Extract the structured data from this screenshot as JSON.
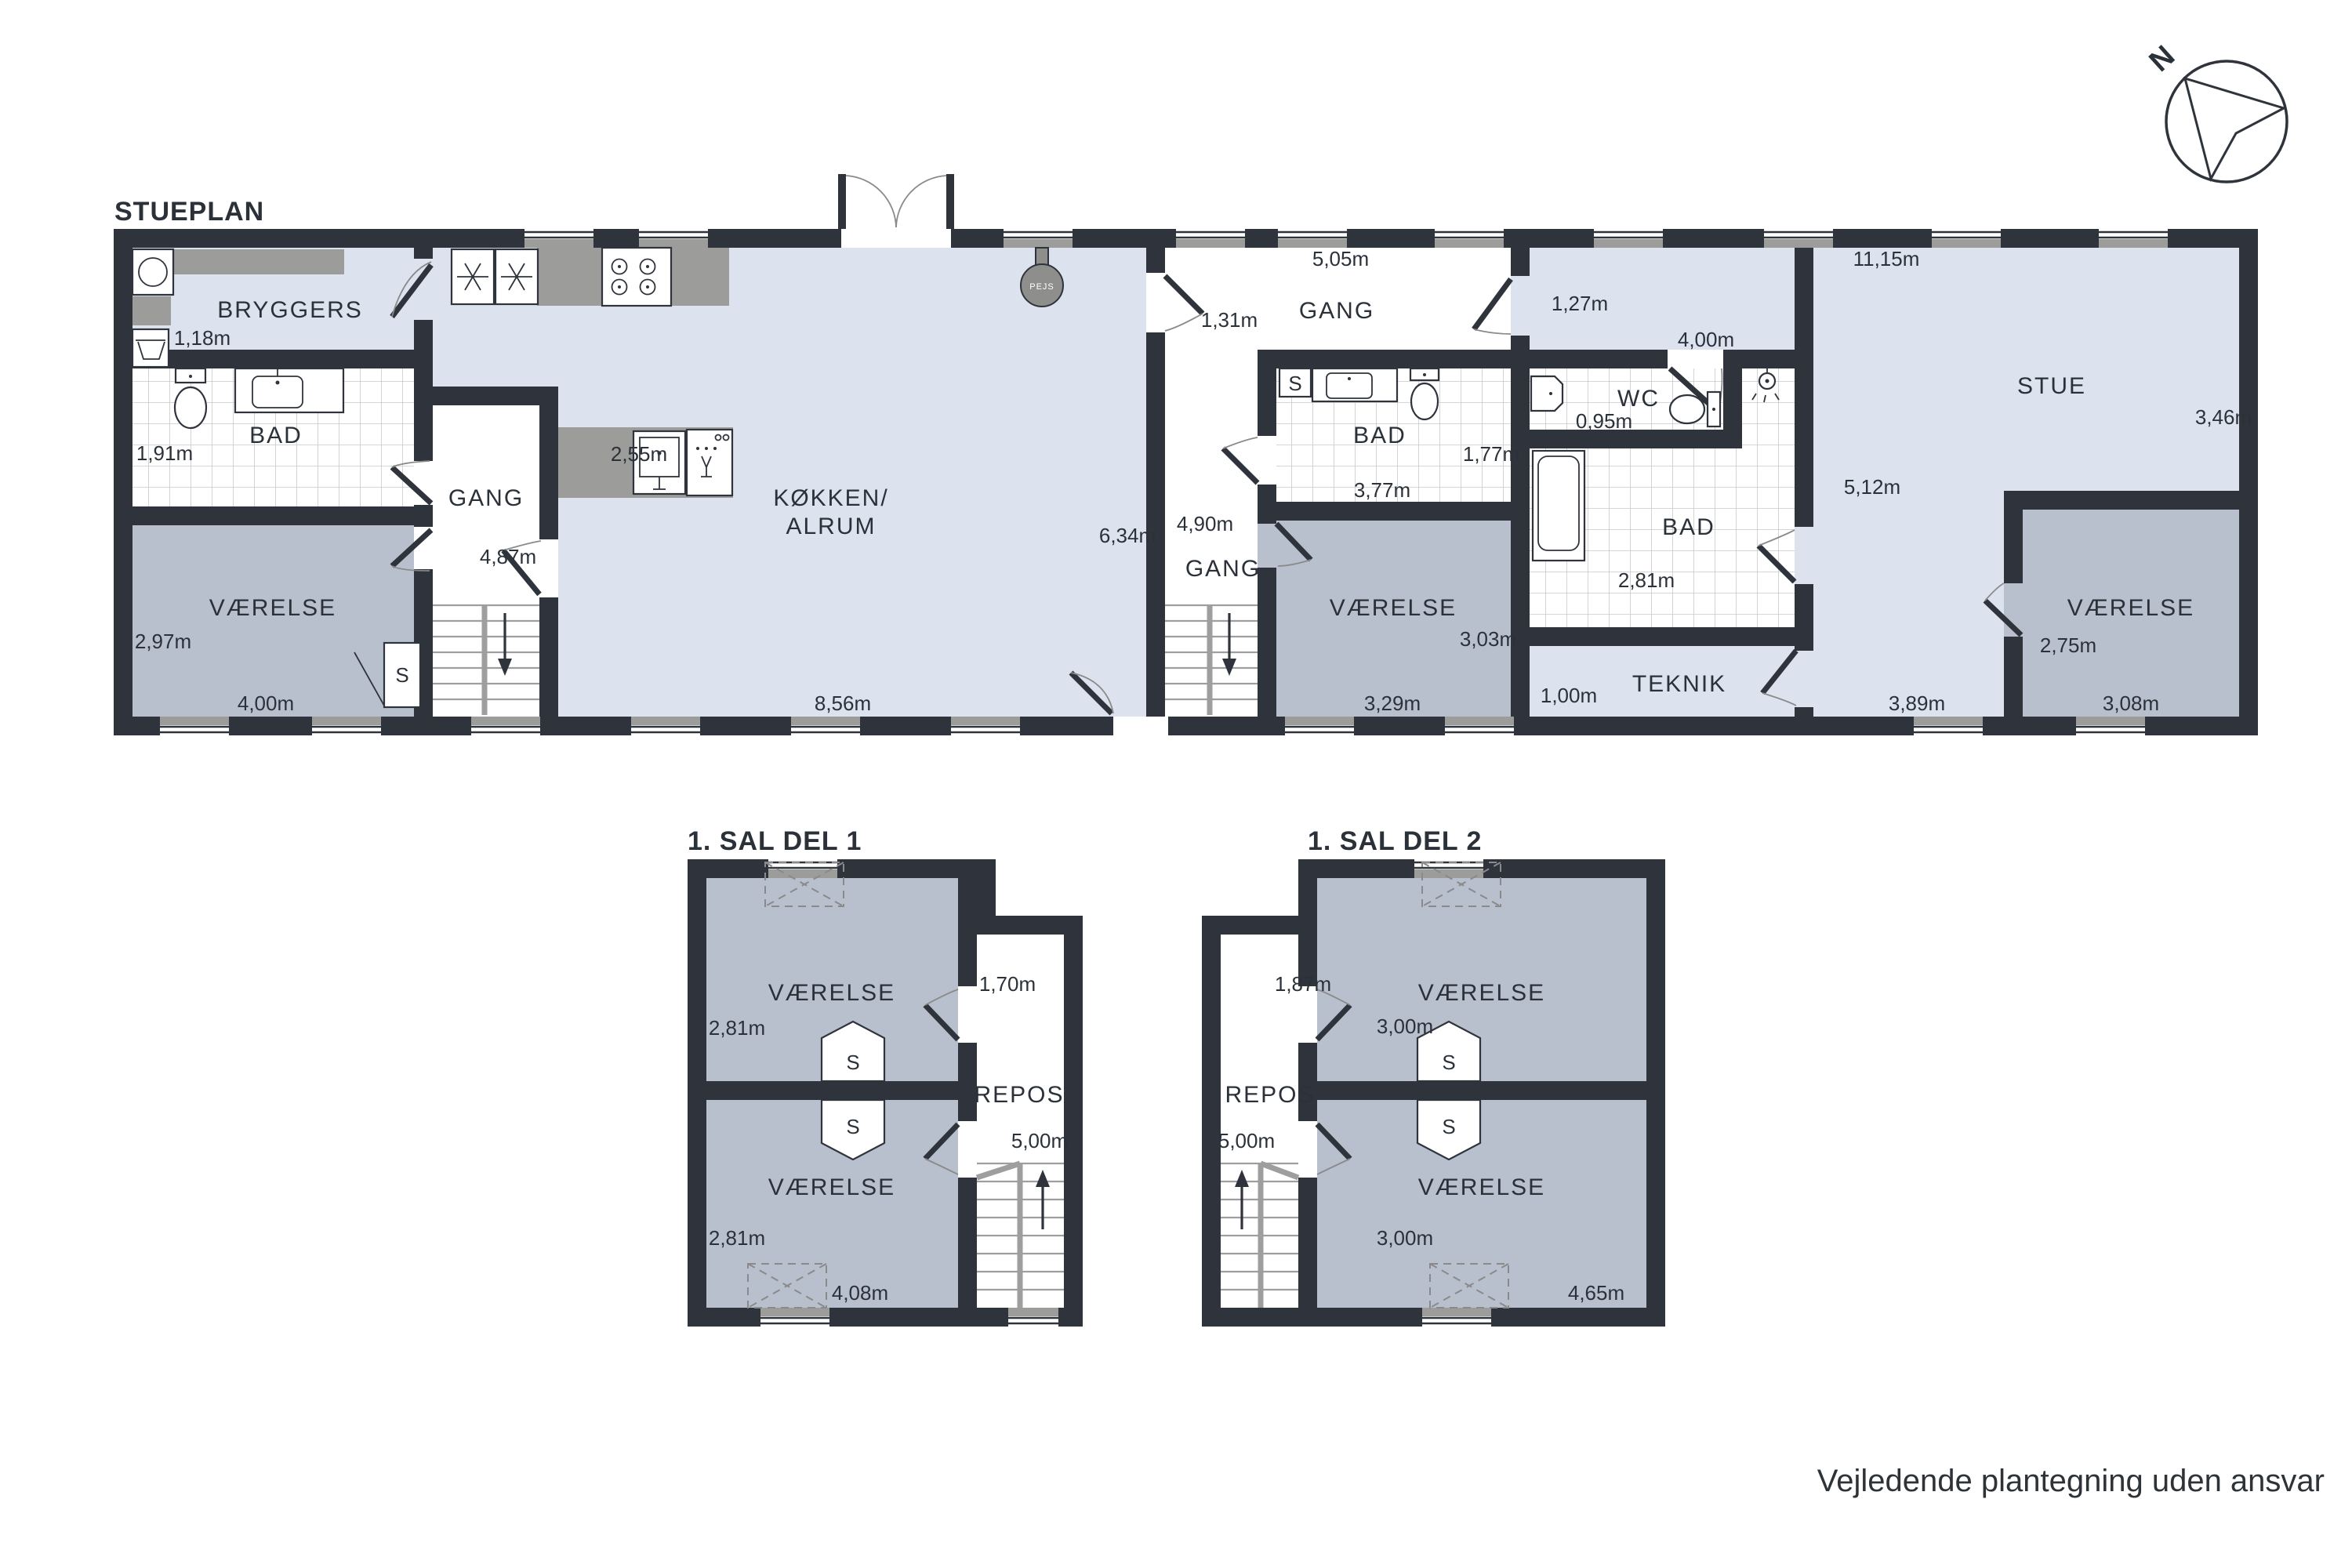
{
  "page": {
    "footer": "Vejledende plantegning uden ansvar",
    "compass": "N",
    "colors": {
      "wall": "#2f343c",
      "floor_light": "#dce3ee",
      "floor_room": "#b8c0ce",
      "floor_hall": "#ffffff",
      "counter_gray": "#9c9c9a",
      "text": "#2b3139"
    }
  },
  "stueplan": {
    "title": "STUEPLAN",
    "labels": {
      "bryggers": "BRYGGERS",
      "bad_left": "BAD",
      "gang_left": "GANG",
      "vaerelse_left": "VÆRELSE",
      "koekken_line1": "KØKKEN/",
      "koekken_line2": "ALRUM",
      "pejs": "PEJS",
      "gang_entry": "GANG",
      "bad_mid": "BAD",
      "gang_mid": "GANG",
      "vaerelse_mid": "VÆRELSE",
      "wc": "WC",
      "bad_right": "BAD",
      "teknik": "TEKNIK",
      "stue": "STUE",
      "vaerelse_right": "VÆRELSE",
      "closet": "S"
    },
    "dims": {
      "bryggers": "1,18m",
      "bad_left_h": "1,91m",
      "gang_left": "4,87m",
      "vaerelse_left_h": "2,97m",
      "vaerelse_left_w": "4,00m",
      "counter": "2,55m",
      "koekken_w": "8,56m",
      "koekken_h": "6,34m",
      "entry_w": "5,05m",
      "entry_pass": "1,31m",
      "pass_right": "1,27m",
      "wc_w": "4,00m",
      "wc_h": "0,95m",
      "bad_mid_h": "1,77m",
      "bad_mid_w": "3,77m",
      "gang_mid": "4,90m",
      "vaerelse_mid_h": "3,03m",
      "vaerelse_mid_w": "3,29m",
      "stue_w": "11,15m",
      "stue_h": "3,46m",
      "bad_right_h": "5,12m",
      "bad_right_w": "2,81m",
      "teknik_h": "1,00m",
      "stue_bottom": "3,89m",
      "vaerelse_right_h": "2,75m",
      "vaerelse_right_w": "3,08m"
    }
  },
  "sal1": {
    "title": "1. SAL DEL 1",
    "labels": {
      "vaerelse_top": "VÆRELSE",
      "vaerelse_bottom": "VÆRELSE",
      "repos": "REPOS",
      "closet": "S"
    },
    "dims": {
      "room_top_h": "2,81m",
      "room_bottom_h": "2,81m",
      "repos_w": "1,70m",
      "repos_h": "5,00m",
      "width": "4,08m"
    }
  },
  "sal2": {
    "title": "1. SAL DEL 2",
    "labels": {
      "vaerelse_top": "VÆRELSE",
      "vaerelse_bottom": "VÆRELSE",
      "repos": "REPOS",
      "closet": "S"
    },
    "dims": {
      "repos_w": "1,87m",
      "room_top_h": "3,00m",
      "room_bottom_h": "3,00m",
      "repos_h": "5,00m",
      "width": "4,65m"
    }
  }
}
